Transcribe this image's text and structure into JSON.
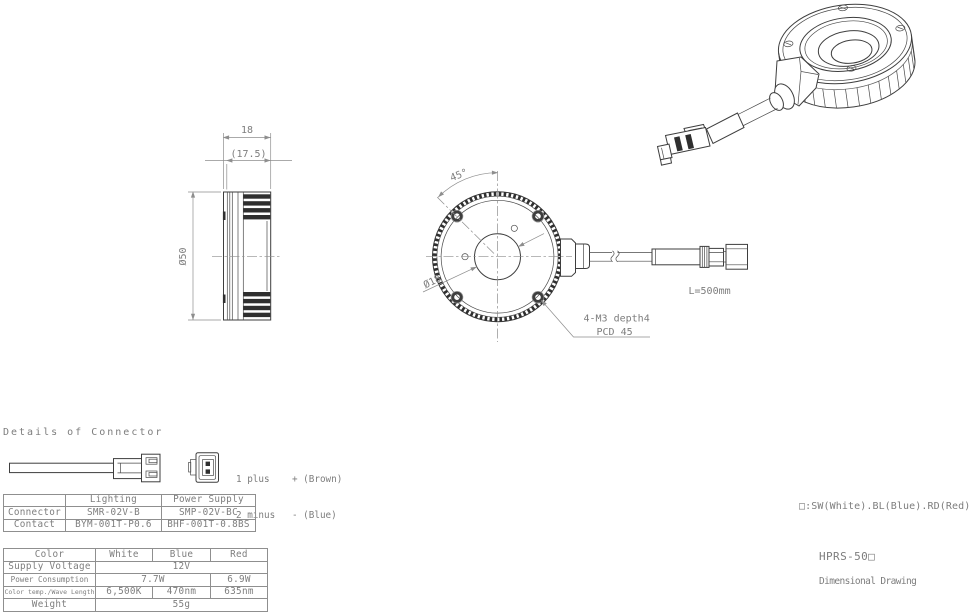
{
  "meta": {
    "background": "#ffffff",
    "line_color": "#3e3e3e",
    "dimension_color": "#8e8e8e",
    "text_color": "#7d7d7d",
    "fin_color": "#2f2f2f"
  },
  "titles": {
    "details_of_connector": "Details of Connector",
    "color_note": "□:SW(White).BL(Blue).RD(Red)",
    "model": "HPRS-50□",
    "doc_type": "Dimensional Drawing"
  },
  "connector_pins": {
    "pin1": "1 plus    + (Brown)",
    "pin2": "2 minus   - (Blue)"
  },
  "dimensions": {
    "side_width": "18",
    "side_width_inner": "(17.5)",
    "outer_diameter": "Ø50",
    "mount_angle": "45°",
    "center_hole_diameter": "Ø18",
    "mount_holes_line1": "4-M3 depth4",
    "mount_holes_line2": "PCD 45",
    "cable_length": "L=500mm"
  },
  "connector_table": {
    "col_headers": [
      "",
      "Lighting",
      "Power Supply"
    ],
    "rows": [
      {
        "label": "Connector",
        "lighting": "SMR-02V-B",
        "power_supply": "SMP-02V-BC"
      },
      {
        "label": "Contact",
        "lighting": "BYM-001T-P0.6",
        "power_supply": "BHF-001T-0.8BS"
      }
    ]
  },
  "spec_table": {
    "col_headers": [
      "Color",
      "White",
      "Blue",
      "Red"
    ],
    "supply_voltage": {
      "label": "Supply Voltage",
      "value": "12V"
    },
    "power_consumption": {
      "label": "Power Consumption",
      "white_blue": "7.7W",
      "red": "6.9W"
    },
    "color_temp_wave": {
      "label": "Color temp./Wave Length",
      "white": "6,500K",
      "blue": "470nm",
      "red": "635nm"
    },
    "weight": {
      "label": "Weight",
      "value": "55g"
    }
  }
}
